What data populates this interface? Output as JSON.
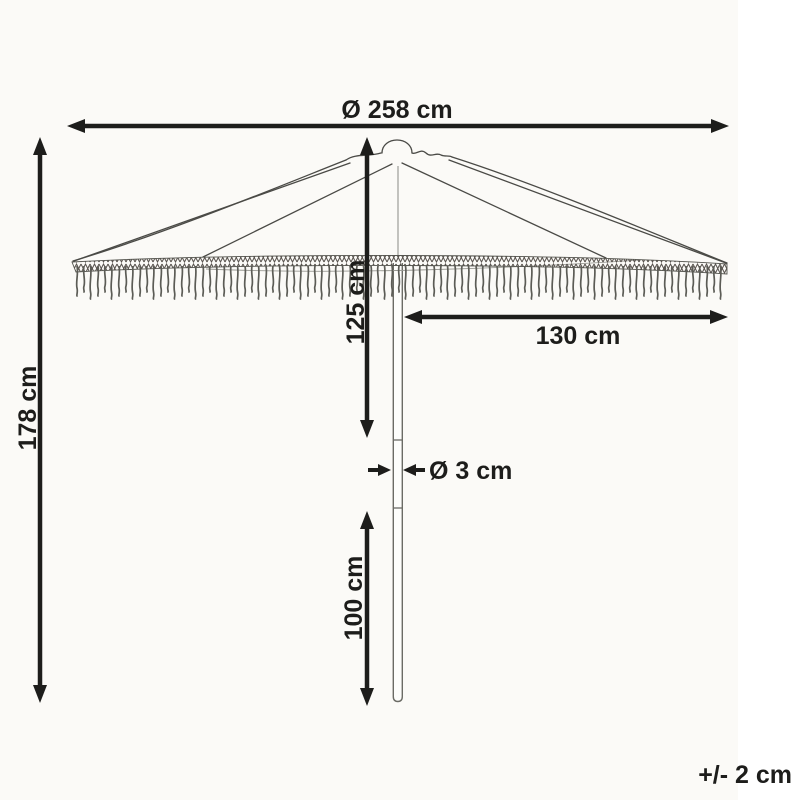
{
  "diagram_type": "product-dimension-diagram",
  "product": "fringed parasol / garden umbrella",
  "dimensions": {
    "canopy_diameter": "Ø 258 cm",
    "total_height": "178 cm",
    "upper_height": "125 cm",
    "canopy_radius": "130 cm",
    "pole_diameter": "Ø 3 cm",
    "lower_height": "100 cm"
  },
  "tolerance": "+/- 2 cm",
  "colors": {
    "ink": "#1d1d1b",
    "line_art": "#4a4a46",
    "background": "#fbfaf7"
  }
}
